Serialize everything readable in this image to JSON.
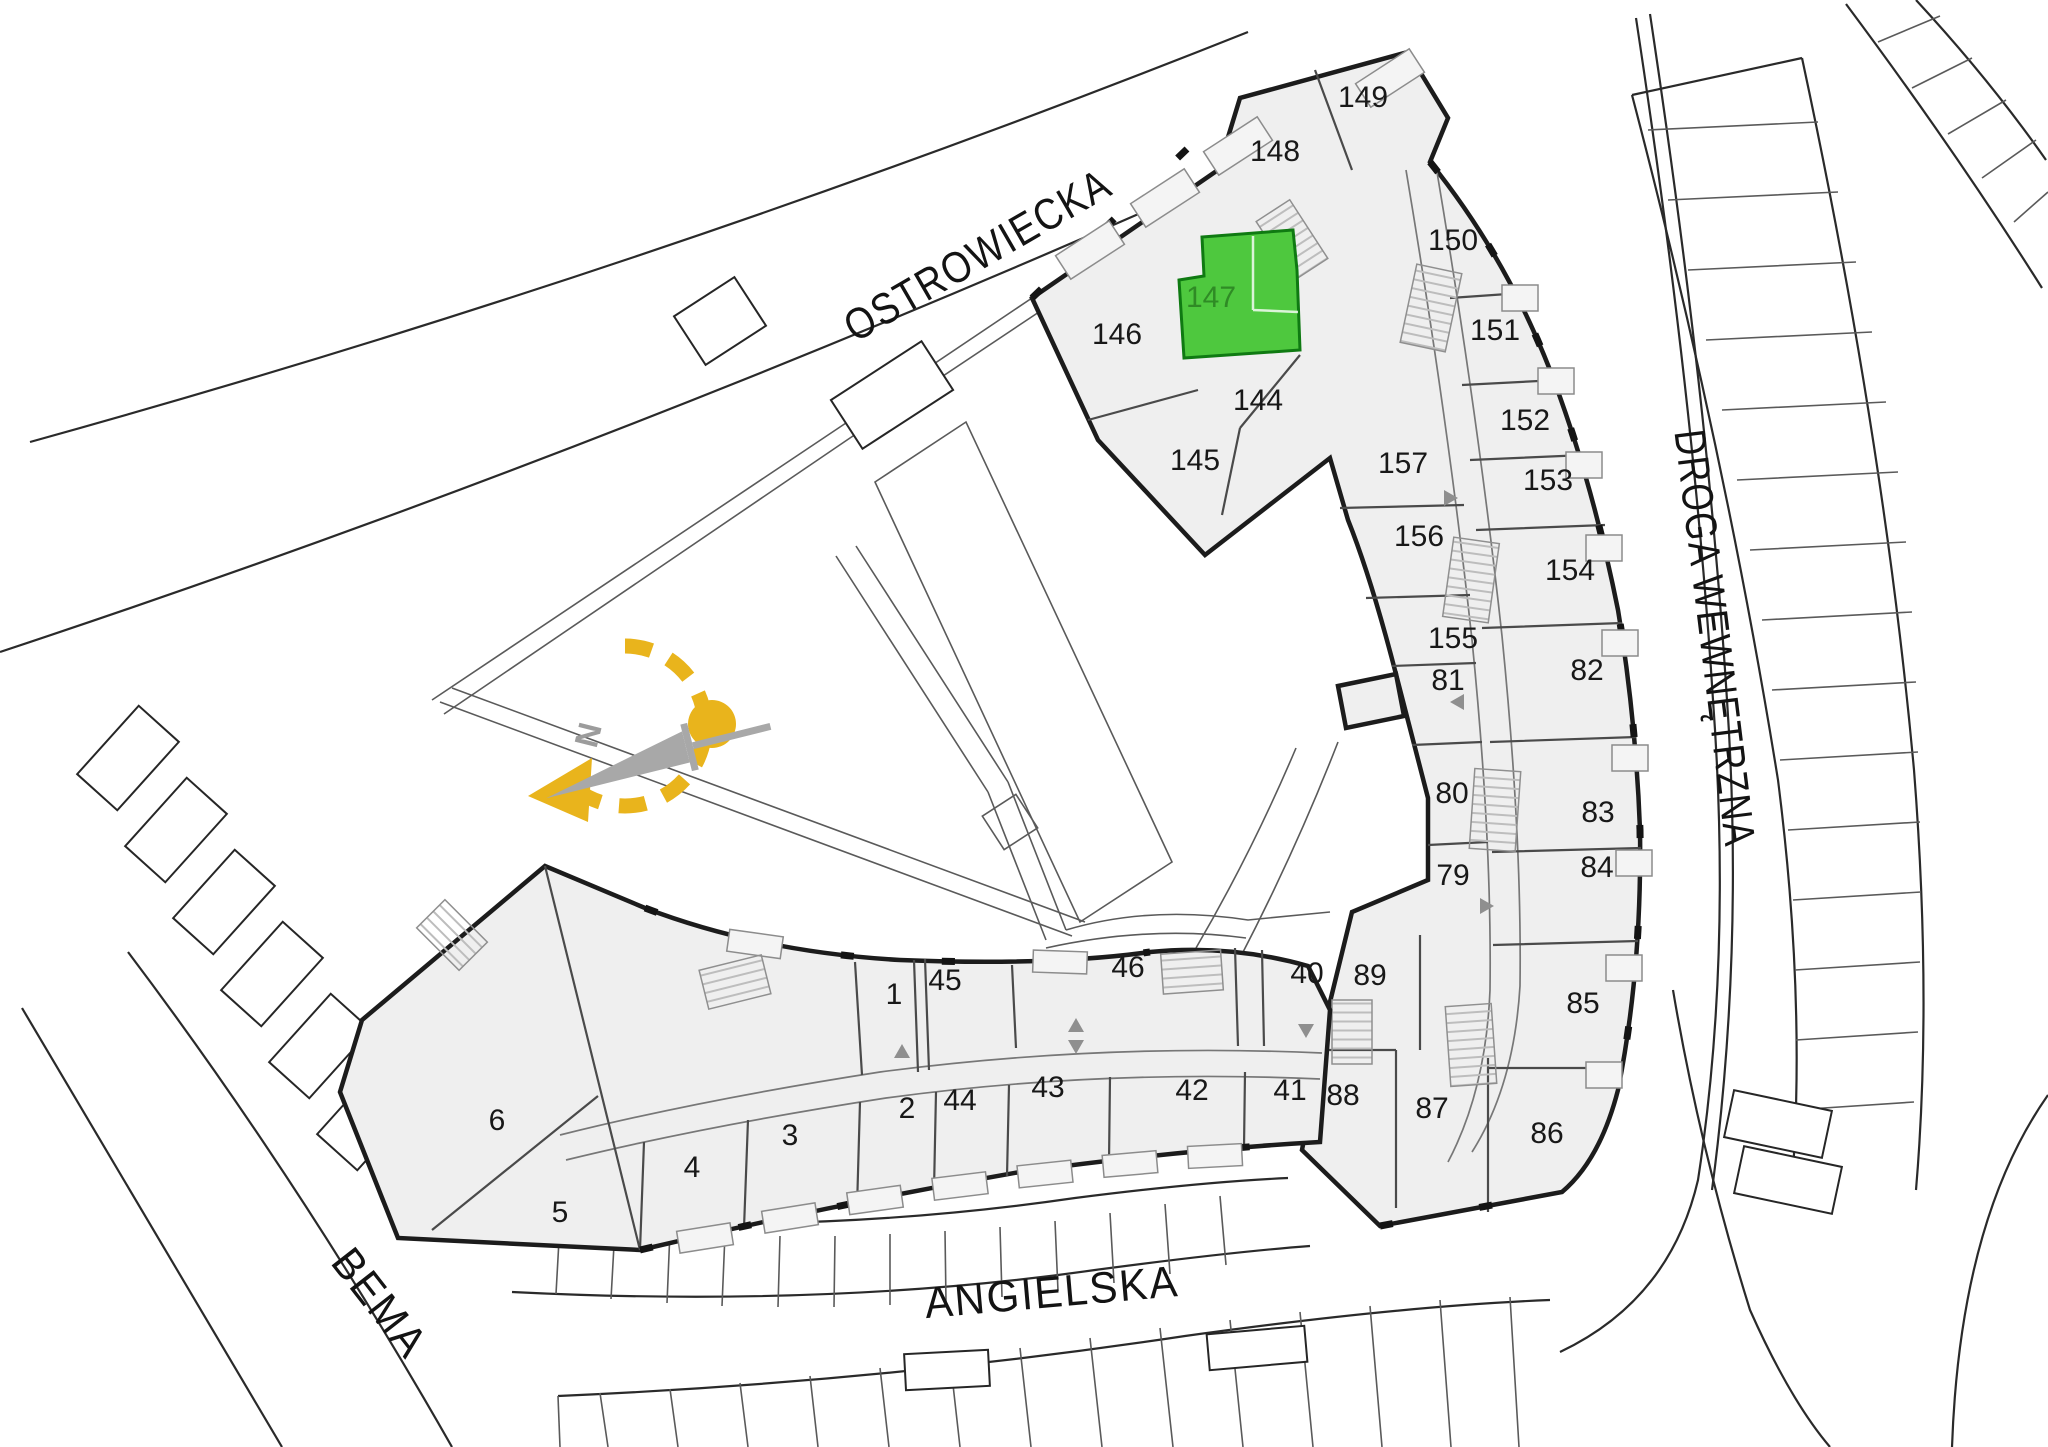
{
  "map_type": "residential site plan",
  "highlight": {
    "unit": "147"
  },
  "colors": {
    "highlight_green": "#4ec83e",
    "highlight_text": "#2f8b25",
    "compass_yellow": "#e9b41c",
    "wall": "#1c1c1c",
    "building_fill": "#efefef"
  },
  "compass": {
    "label": "N"
  },
  "streets": [
    {
      "id": "ostrowiecka",
      "label": "OSTROWIECKA",
      "x": 985,
      "y": 268,
      "rotation": -30
    },
    {
      "id": "droga-wewnetrzna",
      "label": "DROGA WEWNĘTRZNA",
      "x": 1700,
      "y": 640,
      "rotation": 83
    },
    {
      "id": "angielska",
      "label": "ANGIELSKA",
      "x": 1053,
      "y": 1307,
      "rotation": -5
    },
    {
      "id": "bema",
      "label": "BEMA",
      "x": 368,
      "y": 1312,
      "rotation": 52
    }
  ],
  "units": [
    {
      "label": "149",
      "x": 1363,
      "y": 107
    },
    {
      "label": "148",
      "x": 1275,
      "y": 161
    },
    {
      "label": "150",
      "x": 1453,
      "y": 250
    },
    {
      "label": "147",
      "x": 1211,
      "y": 307,
      "highlighted": true
    },
    {
      "label": "146",
      "x": 1117,
      "y": 344
    },
    {
      "label": "151",
      "x": 1495,
      "y": 340
    },
    {
      "label": "144",
      "x": 1258,
      "y": 410
    },
    {
      "label": "152",
      "x": 1525,
      "y": 430
    },
    {
      "label": "145",
      "x": 1195,
      "y": 470
    },
    {
      "label": "157",
      "x": 1403,
      "y": 473
    },
    {
      "label": "153",
      "x": 1548,
      "y": 490
    },
    {
      "label": "156",
      "x": 1419,
      "y": 546
    },
    {
      "label": "154",
      "x": 1570,
      "y": 580
    },
    {
      "label": "155",
      "x": 1453,
      "y": 648
    },
    {
      "label": "82",
      "x": 1587,
      "y": 680
    },
    {
      "label": "81",
      "x": 1448,
      "y": 690
    },
    {
      "label": "80",
      "x": 1452,
      "y": 803
    },
    {
      "label": "83",
      "x": 1598,
      "y": 822
    },
    {
      "label": "84",
      "x": 1597,
      "y": 877
    },
    {
      "label": "79",
      "x": 1453,
      "y": 885
    },
    {
      "label": "46",
      "x": 1128,
      "y": 977
    },
    {
      "label": "40",
      "x": 1307,
      "y": 983
    },
    {
      "label": "89",
      "x": 1370,
      "y": 985
    },
    {
      "label": "45",
      "x": 945,
      "y": 990
    },
    {
      "label": "1",
      "x": 894,
      "y": 1004
    },
    {
      "label": "85",
      "x": 1583,
      "y": 1013
    },
    {
      "label": "43",
      "x": 1048,
      "y": 1097
    },
    {
      "label": "42",
      "x": 1192,
      "y": 1100
    },
    {
      "label": "41",
      "x": 1290,
      "y": 1100
    },
    {
      "label": "88",
      "x": 1343,
      "y": 1105
    },
    {
      "label": "44",
      "x": 960,
      "y": 1110
    },
    {
      "label": "2",
      "x": 907,
      "y": 1118
    },
    {
      "label": "87",
      "x": 1432,
      "y": 1118
    },
    {
      "label": "6",
      "x": 497,
      "y": 1130
    },
    {
      "label": "86",
      "x": 1547,
      "y": 1143
    },
    {
      "label": "3",
      "x": 790,
      "y": 1145
    },
    {
      "label": "4",
      "x": 692,
      "y": 1177
    },
    {
      "label": "5",
      "x": 560,
      "y": 1222
    }
  ]
}
